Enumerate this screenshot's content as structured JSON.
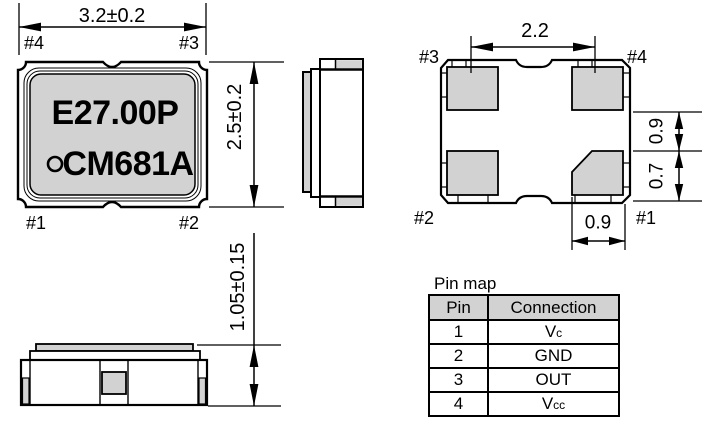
{
  "top_view": {
    "dim_width": "3.2±0.2",
    "dim_height": "2.5±0.2",
    "marking_line1": "E27.00P",
    "marking_line2": "CM681A",
    "pin_labels": {
      "top_left": "#4",
      "top_right": "#3",
      "bottom_left": "#1",
      "bottom_right": "#2"
    }
  },
  "front_view": {
    "dim_height": "1.05±0.15"
  },
  "bottom_view": {
    "dim_pad_pitch": "2.2",
    "dim_pad_height": "0.9",
    "dim_pad_clearance": "0.7",
    "dim_pad_width": "0.9",
    "pin_labels": {
      "top_left": "#3",
      "top_right": "#4",
      "bottom_left": "#2",
      "bottom_right": "#1"
    }
  },
  "pin_map": {
    "title": "Pin map",
    "headers": [
      "Pin",
      "Connection"
    ],
    "rows": [
      {
        "pin": "1",
        "connection_main": "V",
        "connection_sub": "c"
      },
      {
        "pin": "2",
        "connection_main": "GND",
        "connection_sub": ""
      },
      {
        "pin": "3",
        "connection_main": "OUT",
        "connection_sub": ""
      },
      {
        "pin": "4",
        "connection_main": "V",
        "connection_sub": "cc"
      }
    ]
  },
  "colors": {
    "line": "#000000",
    "fill_gray": "#d2d2d2",
    "background": "#ffffff"
  }
}
